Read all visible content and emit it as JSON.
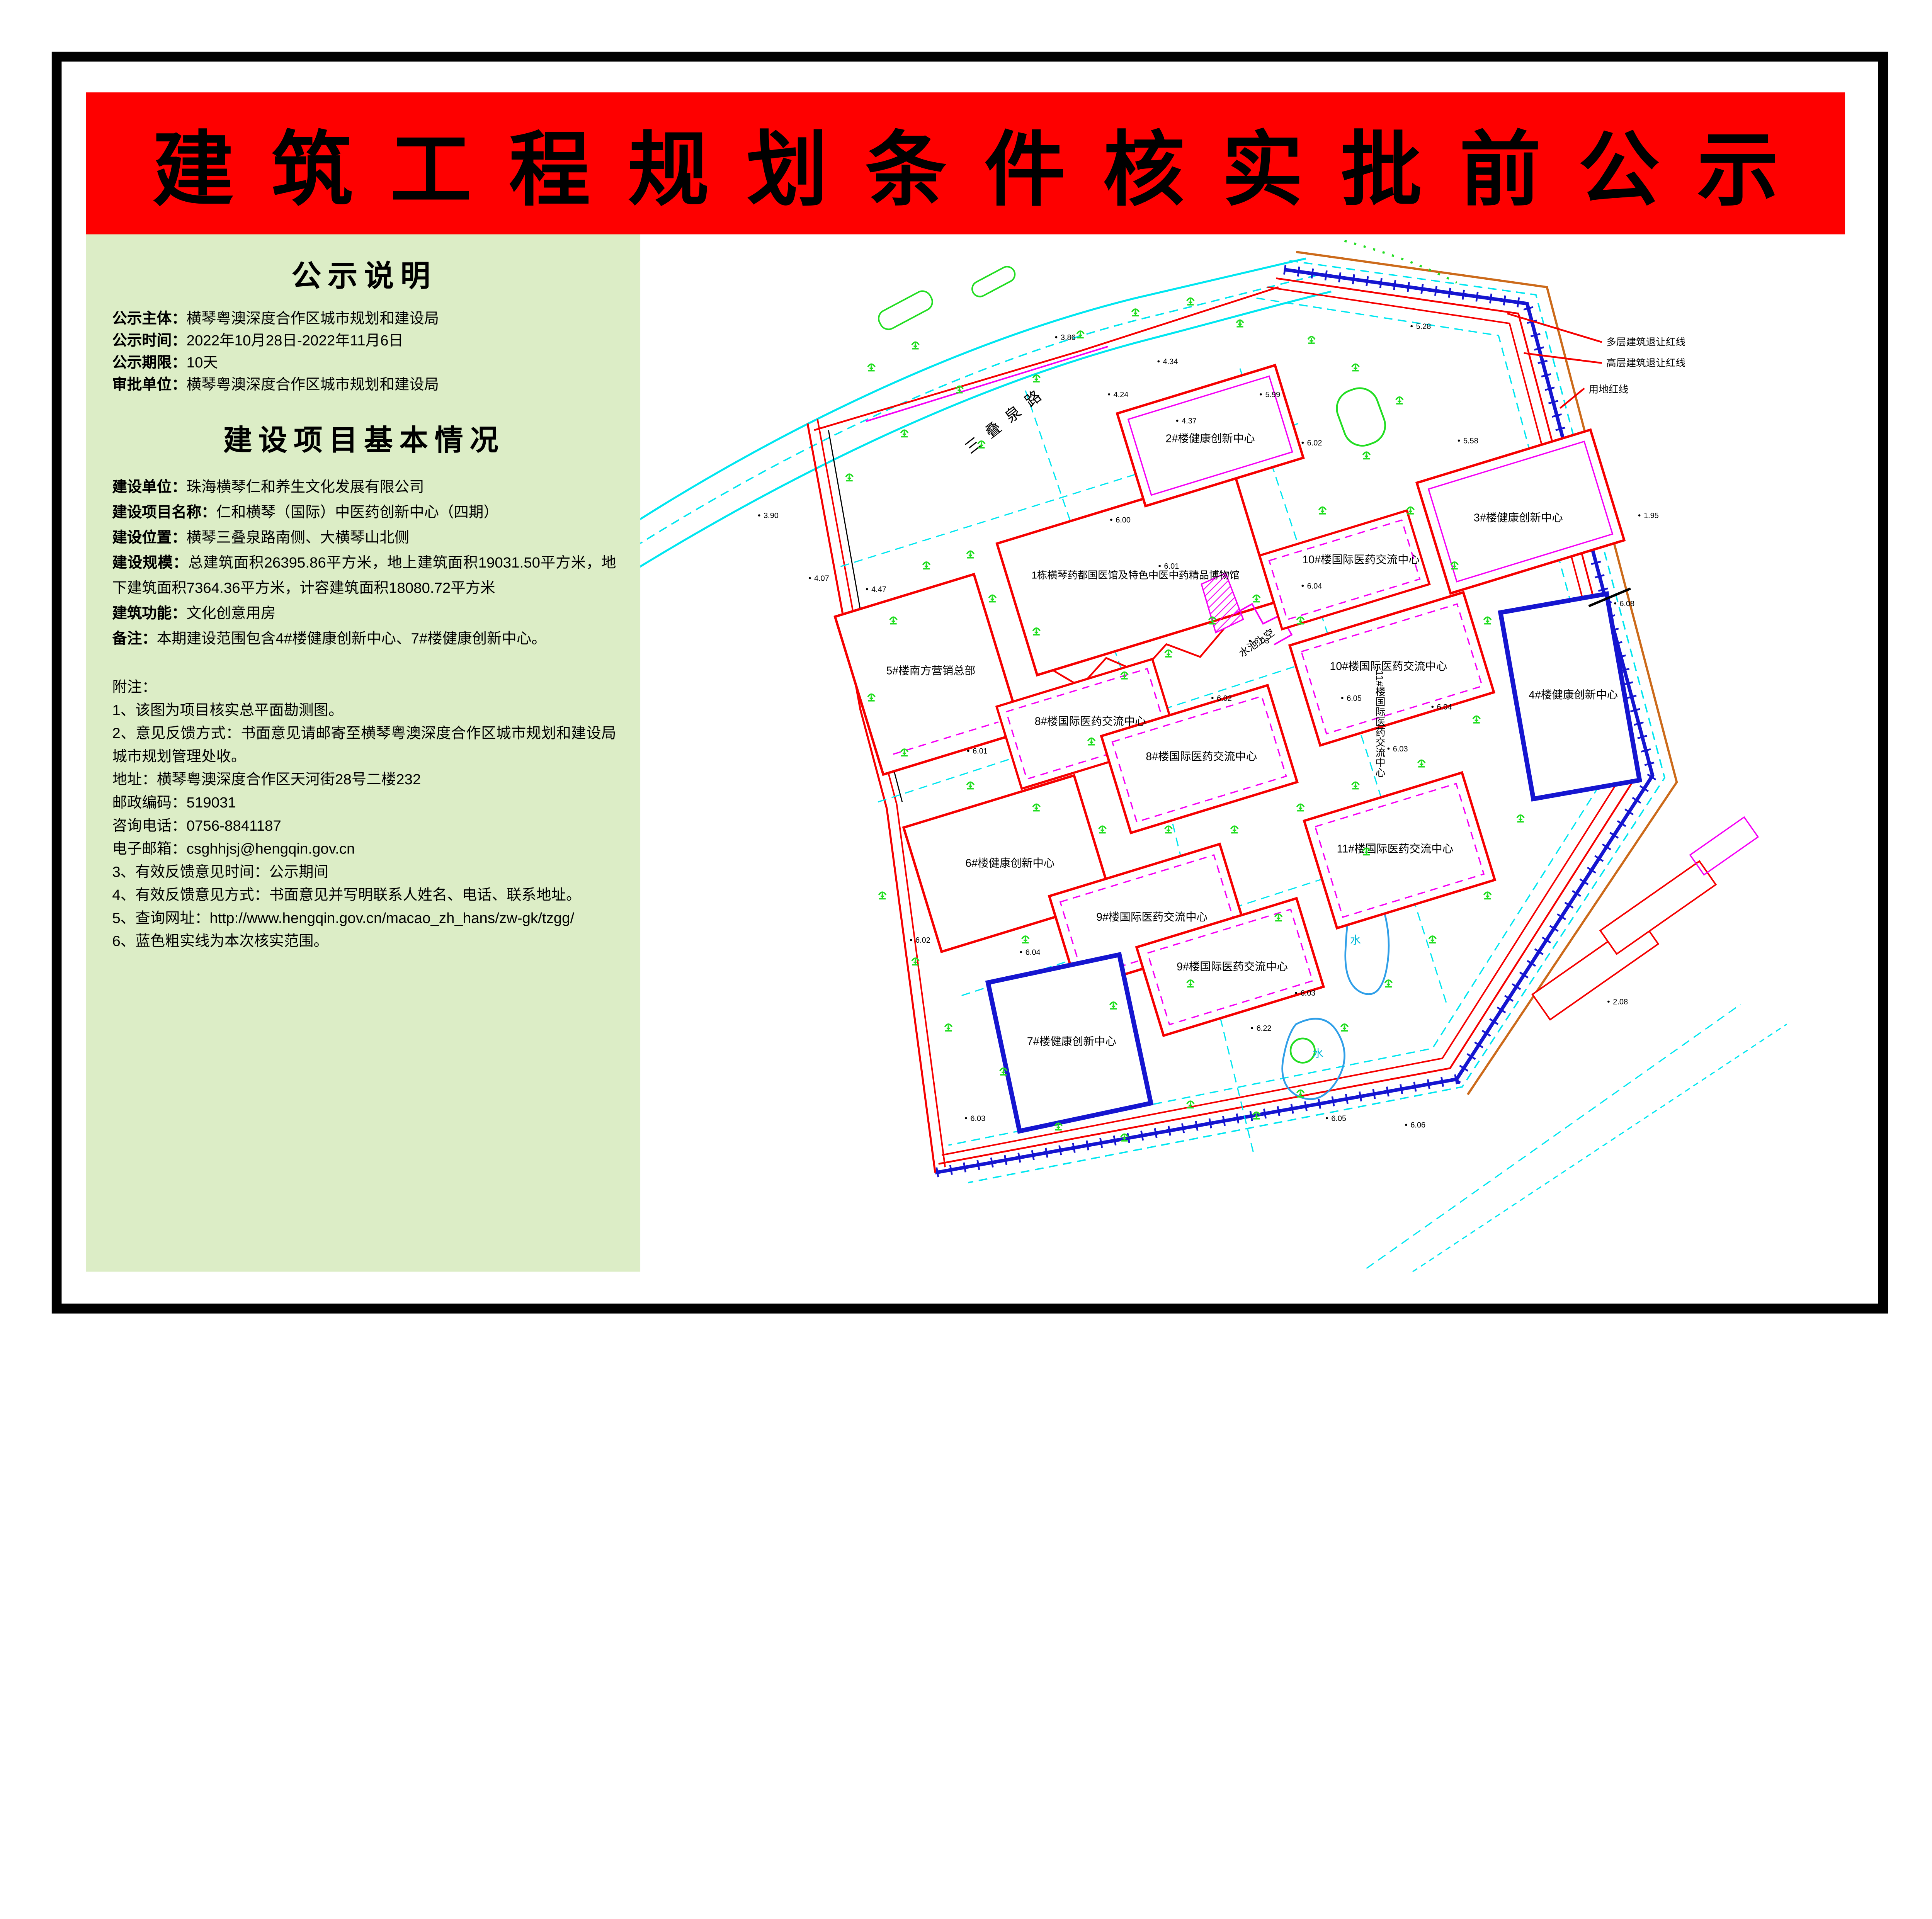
{
  "banner": {
    "title": "建筑工程规划条件核实批前公示"
  },
  "colors": {
    "banner_red": "#fe0000",
    "panel_green": "#dcedc6",
    "boundary_blue": "#1515d0",
    "cad_cyan": "#00e6f0",
    "cad_red": "#f50000",
    "cad_magenta": "#f500f5",
    "cad_green": "#22dd22",
    "cad_orange": "#cc6a1a",
    "water_blue": "#2f9fe8",
    "text_black": "#000000"
  },
  "notice": {
    "heading": "公示说明",
    "items": [
      {
        "label": "公示主体：",
        "value": "横琴粤澳深度合作区城市规划和建设局"
      },
      {
        "label": "公示时间：",
        "value": "2022年10月28日-2022年11月6日"
      },
      {
        "label": "公示期限：",
        "value": "10天"
      },
      {
        "label": "审批单位：",
        "value": "横琴粤澳深度合作区城市规划和建设局"
      }
    ]
  },
  "project": {
    "heading": "建设项目基本情况",
    "items": [
      {
        "label": "建设单位：",
        "value": "珠海横琴仁和养生文化发展有限公司"
      },
      {
        "label": "建设项目名称：",
        "value": "仁和横琴（国际）中医药创新中心（四期）"
      },
      {
        "label": "建设位置：",
        "value": "横琴三叠泉路南侧、大横琴山北侧"
      },
      {
        "label": "建设规模：",
        "value": "总建筑面积26395.86平方米，地上建筑面积19031.50平方米，地下建筑面积7364.36平方米，计容建筑面积18080.72平方米"
      },
      {
        "label": "建筑功能：",
        "value": "文化创意用房"
      },
      {
        "label": "备注：",
        "value": "本期建设范围包含4#楼健康创新中心、7#楼健康创新中心。"
      }
    ]
  },
  "remarks": {
    "heading": "附注：",
    "lines": [
      "1、该图为项目核实总平面勘测图。",
      "2、意见反馈方式：书面意见请邮寄至横琴粤澳深度合作区城市规划和建设局城市规划管理处收。",
      "地址：横琴粤澳深度合作区天河街28号二楼232",
      "邮政编码：519031",
      "咨询电话：0756-8841187",
      "电子邮箱：csghhjsj@hengqin.gov.cn",
      "3、有效反馈意见时间：公示期间",
      "4、有效反馈意见方式：书面意见并写明联系人姓名、电话、联系地址。",
      "5、查询网址：http://www.hengqin.gov.cn/macao_zh_hans/zw-gk/tzgg/",
      "6、蓝色粗实线为本次核实范围。"
    ]
  },
  "map": {
    "road_name": "三叠泉路",
    "setback_labels": [
      "多层建筑退让红线",
      "高层建筑退让红线",
      "用地红线"
    ],
    "building_labels": [
      "2#楼健康创新中心",
      "3#楼健康创新中心",
      "10#楼国际医药交流中心",
      "1栋横琴药都国医馆及特色中医中药精品博物馆",
      "10#楼国际医药交流中心",
      "4#楼健康创新中心",
      "5#楼南方营销总部",
      "8#楼国际医药交流中心",
      "8#楼国际医药交流中心",
      "6#楼健康创新中心",
      "11#楼国际医药交流中心",
      "11#楼国际医药交流中心",
      "9#楼国际医药交流中心",
      "9#楼国际医药交流中心",
      "7#楼健康创新中心"
    ],
    "water_labels": [
      "水池上空",
      "水",
      "水"
    ],
    "spot_elevations": [
      "3.90",
      "4.07",
      "4.47",
      "3.86",
      "4.24",
      "4.34",
      "4.37",
      "5.28",
      "5.58",
      "1.95",
      "6.08",
      "5.99",
      "6.02",
      "6.00",
      "6.01",
      "6.04",
      "6.03",
      "6.02",
      "6.05",
      "6.03",
      "6.04",
      "6.01",
      "6.04",
      "6.03",
      "6.22",
      "2.08",
      "6.05",
      "6.06",
      "6.03",
      "6.02"
    ]
  }
}
